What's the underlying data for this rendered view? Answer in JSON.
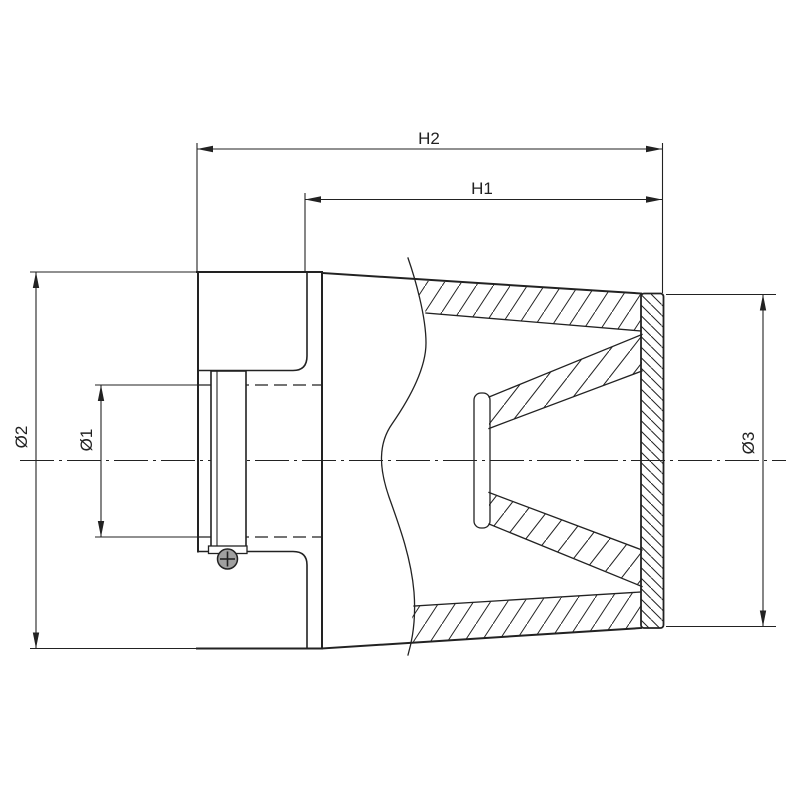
{
  "drawing": {
    "labels": {
      "h2": "H2",
      "h1": "H1",
      "d1": "Ø1",
      "d2": "Ø2",
      "d3": "Ø3"
    },
    "colors": {
      "line": "#222222",
      "background": "#ffffff",
      "screw-fill": "#a0a0a0"
    }
  }
}
